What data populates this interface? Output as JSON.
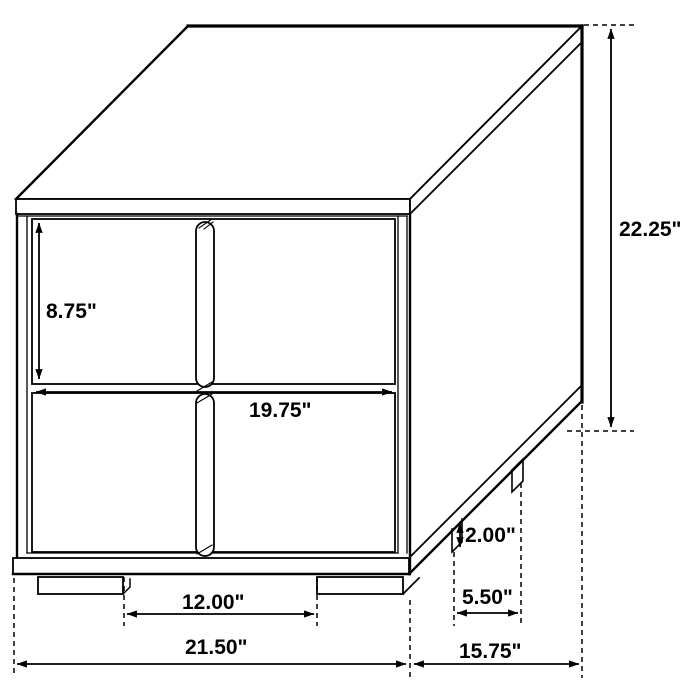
{
  "diagram": {
    "type": "furniture-dimension-drawing",
    "colors": {
      "line": "#000000",
      "text": "#000000",
      "background": "#ffffff"
    },
    "dimensions": {
      "overall_height": "22.25\"",
      "overall_width": "21.50\"",
      "overall_depth": "15.75\"",
      "drawer_height": "8.75\"",
      "drawer_width": "19.75\"",
      "front_leg_spacing": "12.00\"",
      "side_leg_spacing": "5.50\"",
      "leg_height": "2.00\""
    }
  }
}
